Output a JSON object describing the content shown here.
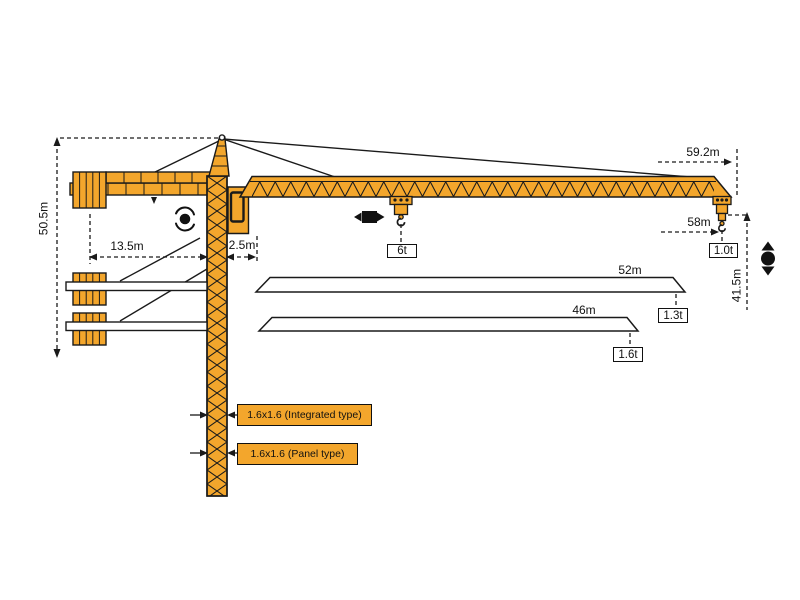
{
  "diagram": {
    "type": "tower-crane load/dimension diagram",
    "colors": {
      "crane": "#f3a62c",
      "outline": "#1a1a1a",
      "background": "#ffffff"
    },
    "dimensions": {
      "tower_height": "50.5m",
      "counter_jib_radius": "13.5m",
      "slew_clearance": "2.5m",
      "jib_tip_radius": "59.2m",
      "max_hook_radius": "58m",
      "hook_height": "41.5m"
    },
    "jib_variants": {
      "len_52": "52m",
      "len_46": "46m"
    },
    "loads": {
      "mid_jib": "6t",
      "tip_59m": "1.0t",
      "tip_52m": "1.3t",
      "tip_46m": "1.6t"
    },
    "mast_sections": {
      "integrated": "1.6x1.6 (Integrated type)",
      "panel": "1.6x1.6 (Panel type)"
    },
    "icons": [
      "rotation-icon",
      "trolley-travel-icon",
      "hook-travel-icon"
    ]
  }
}
